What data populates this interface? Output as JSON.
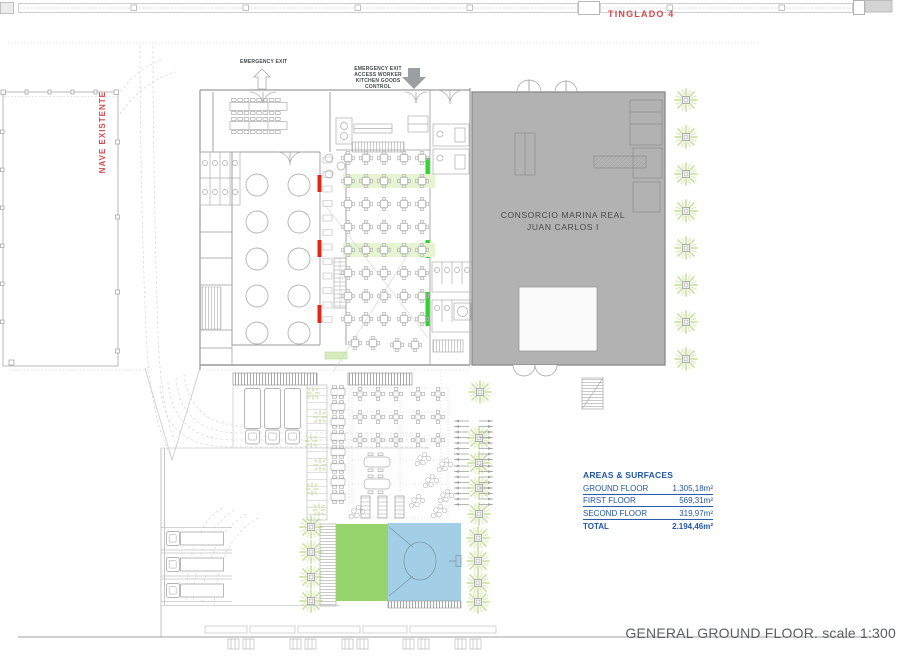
{
  "drawing": {
    "top_label": "TINGLADO 4",
    "left_building_label": "NAVE EXISTENTE",
    "exit_label": "EMERGENCY EXIT",
    "service_entrance_lines": [
      "EMERGENCY EXIT",
      "ACCESS WORKER",
      "KITCHEN GOODS",
      "CONTROL"
    ],
    "gray_building_name": [
      "CONSORCIO MARINA REAL",
      "JUAN CARLOS I"
    ],
    "title": "GENERAL GROUND FLOOR. scale 1:300"
  },
  "areas_table": {
    "title": "AREAS & SURFACES",
    "rows": [
      {
        "label": "GROUND FLOOR",
        "value": "1.305,18m²"
      },
      {
        "label": "FIRST FLOOR",
        "value": "569,31m²"
      },
      {
        "label": "SECOND FLOOR",
        "value": "319,97m²"
      }
    ],
    "total_row": {
      "label": "TOTAL",
      "value": "2.194,46m²"
    }
  },
  "colors": {
    "red_accent": "#d6494d",
    "table_blue": "#2356a8",
    "existing_building_gray": "#b2b2b2",
    "lawn_green": "#97d46e",
    "court_blue": "#a3cfe6",
    "foliage_green": "#cbe3a2",
    "exit_marker_red": "#e02818",
    "exit_marker_green": "#2ed52e",
    "title_gray": "#5a5e61"
  }
}
